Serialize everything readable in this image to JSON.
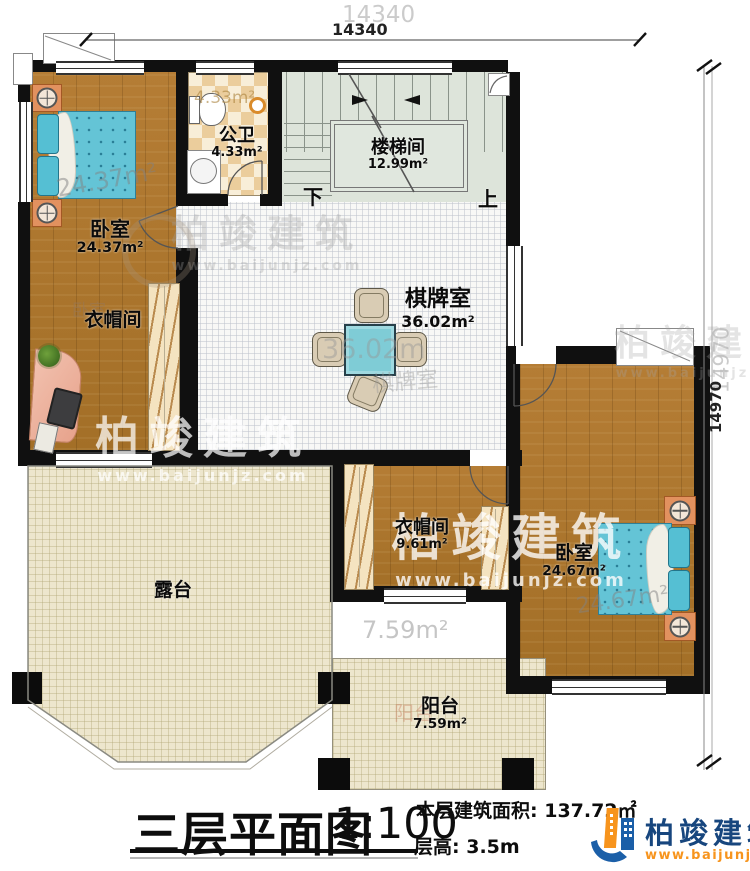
{
  "title_block": {
    "title": "三层平面图",
    "scale": "1:100",
    "area_label": "本层建筑面积:",
    "area_value": "137.72㎡",
    "floor_height_label": "层高:",
    "floor_height_value": "3.5m"
  },
  "brand": {
    "name": "柏竣建筑",
    "url": "www.baijunjz.com"
  },
  "dimensions": {
    "top": "14340",
    "right": "14970"
  },
  "rooms": {
    "bedroom1": {
      "name": "卧室",
      "area": "24.37m²"
    },
    "bathroom": {
      "name": "公卫",
      "area": "4.33m²"
    },
    "stairwell": {
      "name": "楼梯间",
      "area": "12.99m²",
      "down": "下",
      "up": "上"
    },
    "gameroom": {
      "name": "棋牌室",
      "area": "36.02m²"
    },
    "cloakroom_left": {
      "name": "衣帽间"
    },
    "cloakroom_right": {
      "name": "衣帽间",
      "area": "9.61m²"
    },
    "bedroom2": {
      "name": "卧室",
      "area": "24.67m²"
    },
    "terrace": {
      "name": "露台"
    },
    "balcony": {
      "name": "阳台",
      "area": "7.59m²"
    }
  },
  "echoes": {
    "dim_top": "14340",
    "dim_right": "14970",
    "bedroom1_area": "24.37m²",
    "bathroom_area": "4.33m²",
    "gameroom_area": "36.02m",
    "gameroom_name": "棋牌室",
    "bedroom_ghost": "卧室",
    "balcony_area": "7.59m²",
    "balcony_name": "阳台",
    "bedroom2_area": "24.67m²"
  },
  "watermarks": {
    "name": "柏竣建筑",
    "url": "www.baijunjz.com"
  },
  "colors": {
    "wall": "#101010",
    "bed": "#64c4d6",
    "logo_blue": "#1b5fa8",
    "logo_orange": "#f7941d"
  }
}
